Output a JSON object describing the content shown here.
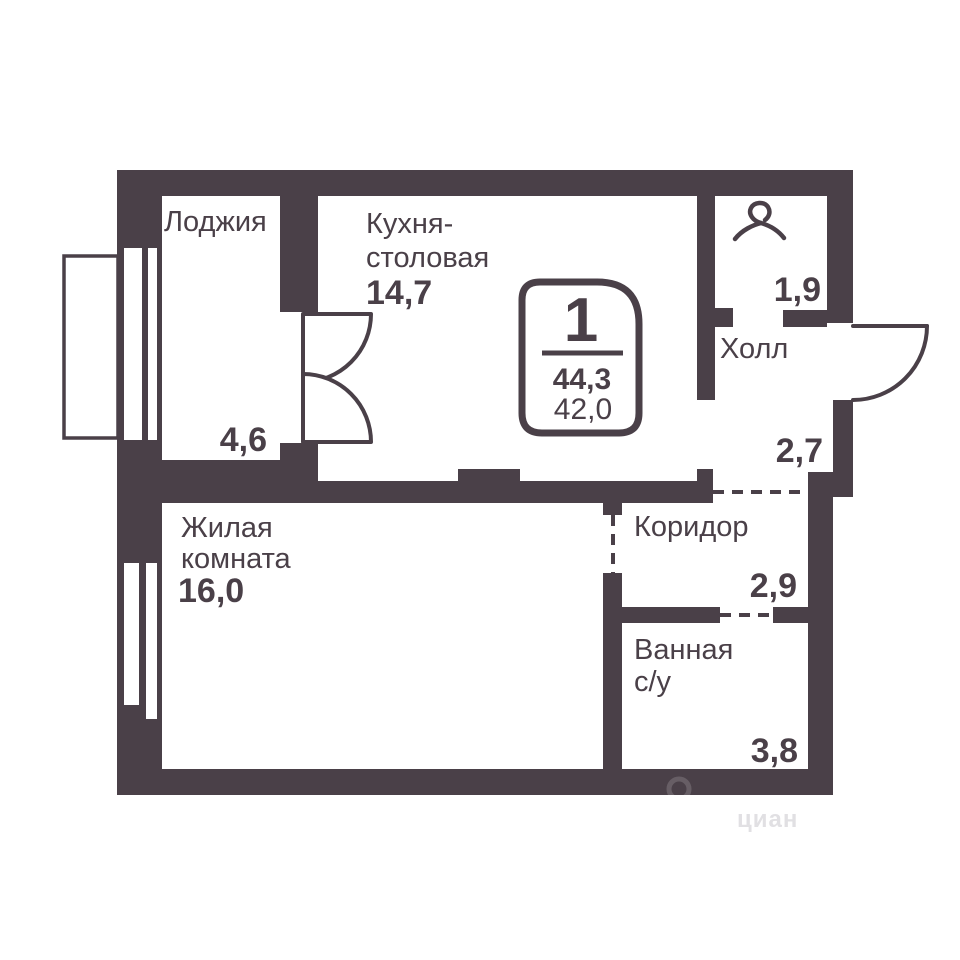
{
  "floorplan": {
    "type": "apartment-floor-plan-1-room",
    "colors": {
      "wall": "#4a4048",
      "background": "#ffffff"
    },
    "badge": {
      "rooms_count": "1",
      "total_area": "44,3",
      "living_area": "42,0"
    },
    "rooms": {
      "loggia": {
        "label": "Лоджия",
        "area": "4,6"
      },
      "kitchen": {
        "label1": "Кухня-",
        "label2": "столовая",
        "area": "14,7"
      },
      "wardrobe": {
        "area": "1,9"
      },
      "hall": {
        "label": "Холл",
        "area": "2,7"
      },
      "corridor": {
        "label": "Коридор",
        "area": "2,9"
      },
      "bathroom": {
        "label1": "Ванная",
        "label2": "с/у",
        "area": "3,8"
      },
      "living": {
        "label1": "Жилая",
        "label2": "комната",
        "area": "16,0"
      }
    },
    "watermark": "циан"
  }
}
